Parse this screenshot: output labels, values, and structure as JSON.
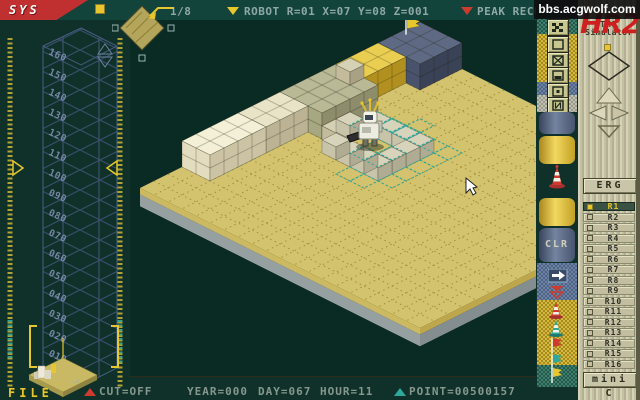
{
  "header": {
    "sys": "SYS",
    "scale": "1/8",
    "robot_status": "ROBOT R=01 X=07 Y=08 Z=001",
    "peak_record": "PEAK RECORD H=003m",
    "watermark": "bbs.acgwolf.com"
  },
  "left_panel": {
    "height_labels": [
      "160",
      "150",
      "140",
      "130",
      "120",
      "110",
      "100",
      "090",
      "080",
      "070",
      "060",
      "050",
      "040",
      "030",
      "020",
      "010",
      "000"
    ],
    "file_label": "FILE"
  },
  "bottom_bar": {
    "cut": "CUT=OFF",
    "year": "YEAR=000",
    "day": "DAY=067",
    "hour": "HOUR=11",
    "point": "POINT=00500157"
  },
  "right_panel": {
    "logo": "HR2",
    "title_line1": "THE",
    "title_line2": "Simulator",
    "erg": "ERG",
    "clr": "CLR",
    "mini": "mini C",
    "registers": [
      "R1",
      "R2",
      "R3",
      "R4",
      "R5",
      "R6",
      "R7",
      "R8",
      "R9",
      "R10",
      "R11",
      "R12",
      "R13",
      "R14",
      "R15",
      "R16"
    ],
    "selected_register": "R1",
    "tool_icons": [
      "grid-dither",
      "square-empty",
      "square-x",
      "square-bar",
      "square-dot",
      "square-n",
      "cone-red-large",
      "arrow-right",
      "double-arrow-down",
      "cone-red",
      "cone-teal",
      "flag-red",
      "flag-teal",
      "flag-yellow"
    ]
  },
  "colors": {
    "accent_yellow": "#e8c62e",
    "red": "#c03030",
    "teal": "#2fa89c",
    "slate_grid": "#3d5170",
    "panel_beige": "#c6c2a6"
  },
  "scene": {
    "origin": [
      290,
      28
    ],
    "cell": [
      14,
      7
    ],
    "lift": 13,
    "platform": {
      "iMax": 20,
      "jMax": 20,
      "top": "#d3c26e",
      "dot": "#a38f35",
      "side_left_top": "#cdb95f",
      "side_right_top": "#bda64b",
      "side_left_base": "#97a0a0",
      "side_right_base": "#848d90"
    },
    "blocks": [
      {
        "name": "navy-stack",
        "i": [
          0,
          2
        ],
        "j": [
          0,
          2
        ],
        "z": 0,
        "h": 2,
        "top": "#5e6a84",
        "left": "#49536b",
        "right": "#394256"
      },
      {
        "name": "yellow-stack",
        "i": [
          3,
          5
        ],
        "j": [
          0,
          1
        ],
        "z": 0,
        "h": 2,
        "top": "#eace52",
        "left": "#d9b637",
        "right": "#b2901f"
      },
      {
        "name": "olive-stack",
        "i": [
          6,
          9
        ],
        "j": [
          0,
          2
        ],
        "z": 0,
        "h": 2,
        "top": "#b9b996",
        "left": "#a7a782",
        "right": "#8d8d6b"
      },
      {
        "name": "olive-top-cube",
        "i": [
          6,
          6
        ],
        "j": [
          1,
          1
        ],
        "z": 2,
        "h": 1,
        "top": "#d5d1b4",
        "left": "#c3bb9c",
        "right": "#a9a184"
      },
      {
        "name": "step-cubes",
        "i": [
          8,
          9
        ],
        "j": [
          3,
          3
        ],
        "z": 0,
        "h": 1,
        "top": "#d5d1b4",
        "left": "#c3bb9c",
        "right": "#a9a184"
      },
      {
        "name": "cream-stack-back",
        "i": [
          10,
          12
        ],
        "j": [
          0,
          1
        ],
        "z": 0,
        "h": 2,
        "top": "#e9e4c8",
        "left": "#d7cfb0",
        "right": "#bbb394"
      },
      {
        "name": "cream-stack-front",
        "i": [
          13,
          16
        ],
        "j": [
          0,
          1
        ],
        "z": 0,
        "h": 2,
        "top": "#f4f0d8",
        "left": "#e4dcbe",
        "right": "#cbc3a4"
      }
    ],
    "walls": {
      "cells": [
        [
          7,
          4
        ],
        [
          7,
          5
        ],
        [
          7,
          6
        ],
        [
          7,
          7
        ],
        [
          8,
          7
        ],
        [
          9,
          7
        ],
        [
          10,
          7
        ],
        [
          10,
          6
        ],
        [
          10,
          5
        ],
        [
          10,
          4
        ],
        [
          8,
          3
        ]
      ],
      "top": "#d8d4bc",
      "left": "#c8c4aa",
      "right": "#b0ac94"
    },
    "wireframe": {
      "color": "#2fa89c",
      "ground": [
        [
          6,
          4
        ],
        [
          6,
          5
        ],
        [
          6,
          6
        ],
        [
          6,
          7
        ],
        [
          6,
          8
        ],
        [
          7,
          8
        ],
        [
          8,
          8
        ],
        [
          9,
          8
        ],
        [
          10,
          8
        ],
        [
          8,
          5
        ],
        [
          8,
          6
        ],
        [
          9,
          5
        ],
        [
          9,
          6
        ],
        [
          7,
          3
        ],
        [
          11,
          6
        ],
        [
          11,
          7
        ]
      ],
      "raised": [
        [
          7,
          4
        ],
        [
          7,
          5
        ],
        [
          7,
          6
        ],
        [
          6,
          6
        ]
      ]
    },
    "flag": {
      "cell": [
        1.4,
        0.4
      ],
      "color": "#e8c62e"
    },
    "robot": {
      "x": 226,
      "y": 86
    },
    "cursor": {
      "x": 336,
      "y": 158
    }
  }
}
